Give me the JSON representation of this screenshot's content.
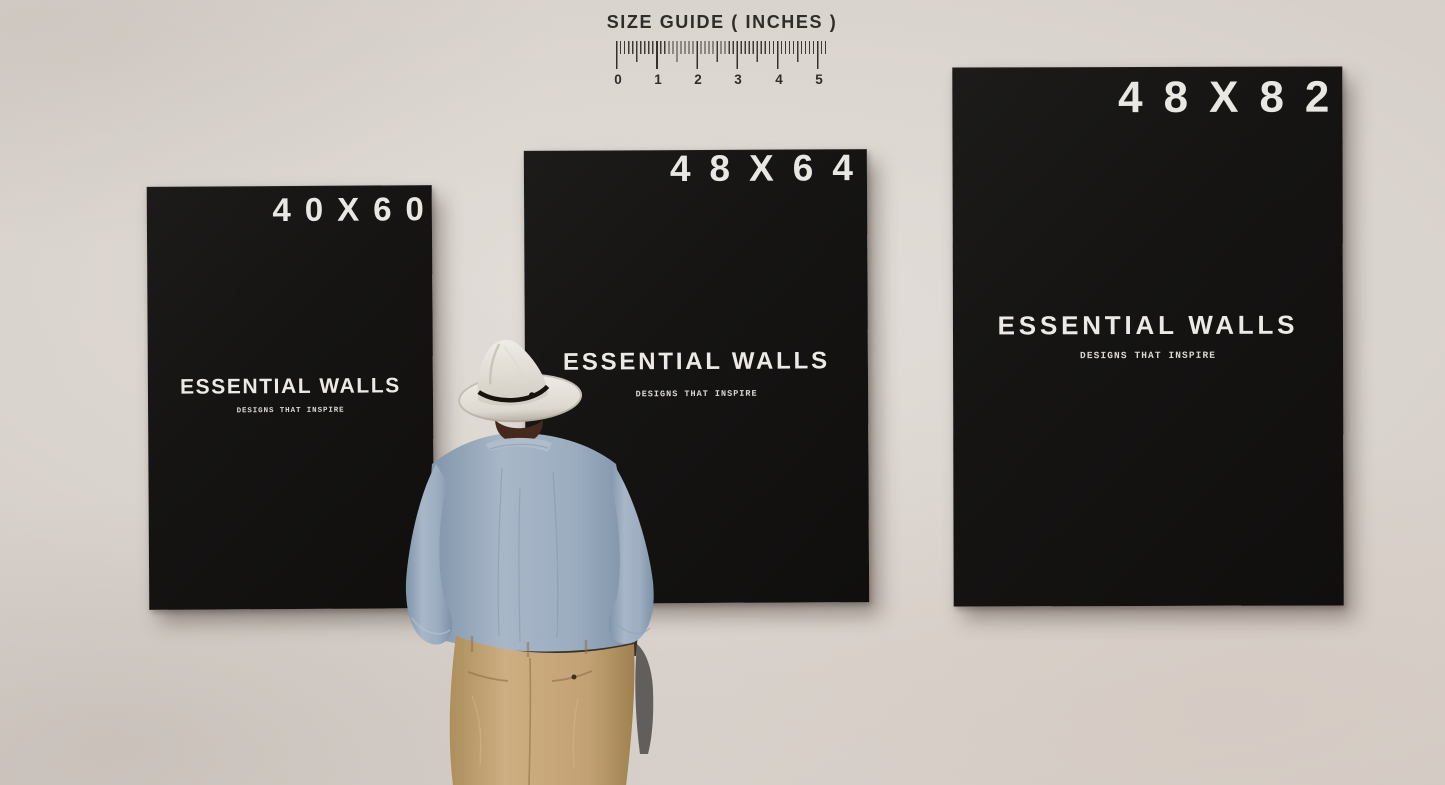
{
  "size_guide": {
    "title": "SIZE GUIDE ( INCHES )",
    "tick_labels": [
      "0",
      "1",
      "2",
      "3",
      "4",
      "5"
    ]
  },
  "posters": [
    {
      "size_label": "40X60",
      "brand": "ESSENTIAL WALLS",
      "tagline": "DESIGNS THAT INSPIRE"
    },
    {
      "size_label": "48X64",
      "brand": "ESSENTIAL WALLS",
      "tagline": "DESIGNS THAT INSPIRE"
    },
    {
      "size_label": "48X82",
      "brand": "ESSENTIAL WALLS",
      "tagline": "DESIGNS THAT INSPIRE"
    }
  ],
  "scene": {
    "figure_description": "Man in a white fedora, blue shirt and khaki trousers viewing the wall art"
  },
  "colors": {
    "wall": "#d6cfc9",
    "poster_background": "#141312",
    "poster_text": "#ece9e4",
    "ruler_text": "#2f2d29",
    "hat": "#e9e6df",
    "hat_band": "#17120e",
    "shirt": "#9fb1c3",
    "pants": "#c6a87c"
  }
}
